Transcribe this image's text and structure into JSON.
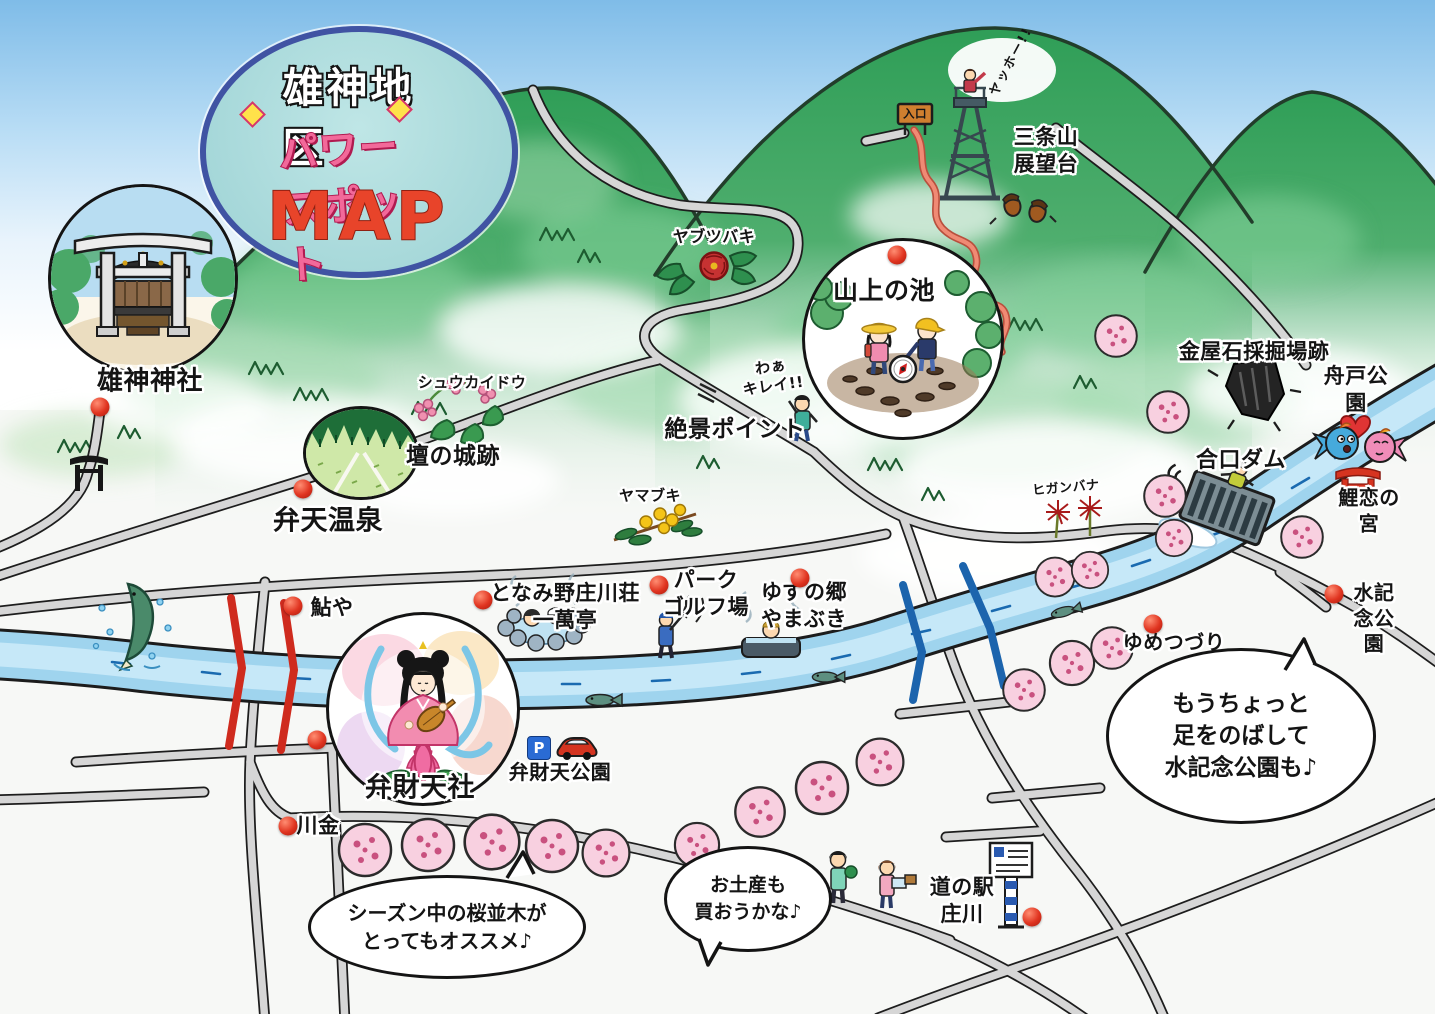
{
  "title_badge": {
    "district": "雄神地区",
    "power_spot": "パワースポット",
    "map_word": "MAP"
  },
  "landmarks": {
    "ogami_shrine": {
      "label": "雄神神社"
    },
    "benten_onsen": {
      "label": "弁天温泉"
    },
    "dan_castle_ruins": {
      "label": "壇の城跡"
    },
    "sanjozan_observatory": {
      "label": "三条山\n展望台"
    },
    "sanjo_pond": {
      "label": "山上の池"
    },
    "zekkei_point": {
      "label": "絶景ポイント"
    },
    "kanaya_quarry": {
      "label": "金屋石採掘場跡"
    },
    "funato_park": {
      "label": "舟戸公園"
    },
    "gouguchi_dam": {
      "label": "合口ダム"
    },
    "koikoi_shrine": {
      "label": "鯉恋の宮"
    },
    "mizu_kinen_park": {
      "label": "水記念公園"
    },
    "yumetsuzuri": {
      "label": "ゆめつづり"
    },
    "ayuya": {
      "label": "鮎や"
    },
    "tonamino_shogawaso": {
      "label": "となみ野庄川荘\n一萬亭"
    },
    "park_golf_course": {
      "label": "パーク\nゴルフ場"
    },
    "yuzu_no_sato": {
      "label": "ゆずの郷\nやまぶき"
    },
    "benzaiten_shrine": {
      "label": "弁財天社"
    },
    "benzaiten_park": {
      "label": "弁財天公園"
    },
    "kawakin": {
      "label": "川金"
    },
    "michinoeki_shogawa": {
      "label": "道の駅\n庄川"
    }
  },
  "flowers": {
    "shukaido": "シュウカイドウ",
    "yabutsubaki": "ヤブツバキ",
    "yamabuki": "ヤマブキ",
    "higanbana": "ヒガンバナ"
  },
  "callouts": {
    "yahho": "ヤッホー!!",
    "waa_kirei": "わぁ\nキレイ!!",
    "sakura_bubble": "シーズン中の桜並木が\nとってもオススメ♪",
    "omiyage_bubble": "お土産も\n買おうかな♪",
    "mizu_bubble": "もうちょっと\n足をのばして\n水記念公園も♪"
  },
  "signs": {
    "entrance": "入口",
    "parking": "P"
  },
  "colors": {
    "marker_red": "#e03420",
    "badge_fill": "#9cd2d4",
    "badge_border": "#4053a3",
    "power_pink": "#f2699a",
    "map_red": "#e8442a",
    "road_gray": "#d6d6d6",
    "river_blue": "#9fd4ee",
    "mountain_green": "#2f9e57",
    "blossom_pink": "#f8d0e0",
    "bridge_red": "#cf2b1e",
    "bridge_blue": "#1c64ad"
  }
}
